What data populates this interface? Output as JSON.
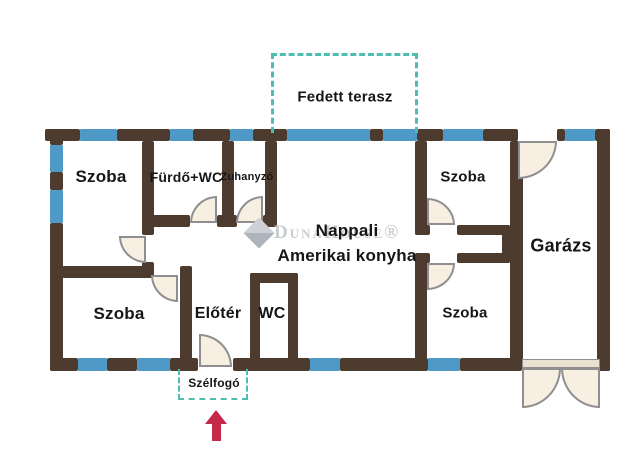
{
  "plan": {
    "type": "residential-floor-plan",
    "language": "hu"
  },
  "rooms": [
    {
      "id": "fedett-terasz",
      "label": "Fedett terasz"
    },
    {
      "id": "szoba-top-left",
      "label": "Szoba"
    },
    {
      "id": "furdo-wc",
      "label": "Fürdő+WC"
    },
    {
      "id": "zuhanyzo",
      "label": "Zuhanyzó"
    },
    {
      "id": "szoba-top-right",
      "label": "Szoba"
    },
    {
      "id": "nappali",
      "label": "Nappali",
      "label2": "Amerikai konyha"
    },
    {
      "id": "garazs",
      "label": "Garázs"
    },
    {
      "id": "szoba-bottom-left",
      "label": "Szoba"
    },
    {
      "id": "eloter",
      "label": "Előtér"
    },
    {
      "id": "wc",
      "label": "WC"
    },
    {
      "id": "szoba-bottom-right",
      "label": "Szoba"
    },
    {
      "id": "szelfogo",
      "label": "Szélfogó"
    }
  ],
  "watermark": {
    "text": "DunaHouse®"
  },
  "colors": {
    "wall_brown": "#4e3b2f",
    "window_blue": "#4e99c5",
    "outline_teal": "#4cbdb0",
    "entry_arrow_red": "#c5294a",
    "door_leaf_fill": "#f6efe2",
    "door_leaf_stroke": "#8f8f8f",
    "watermark_gray": "#c9ccce",
    "background": "#ffffff",
    "text": "#161616"
  }
}
